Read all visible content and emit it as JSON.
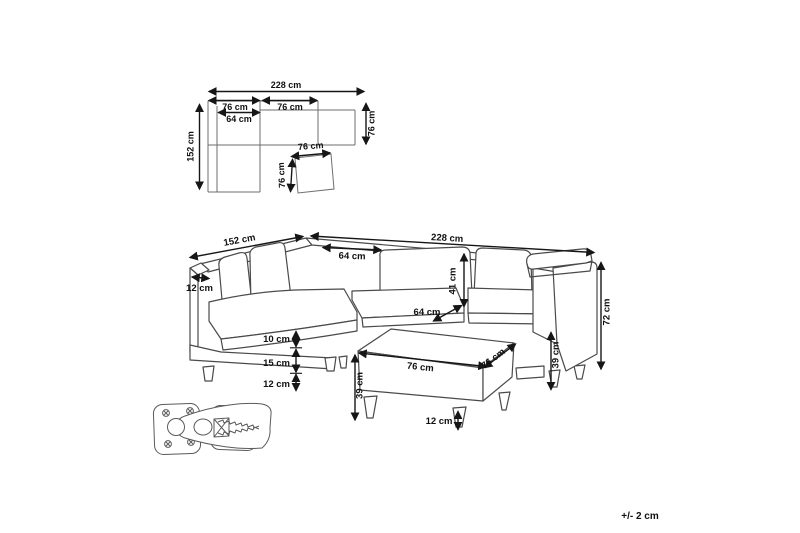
{
  "plan_view": {
    "total_width": "228 cm",
    "left_module_width": "76 cm",
    "right_module_width": "76 cm",
    "seat_width": "64 cm",
    "total_depth": "152 cm",
    "right_depth": "76 cm",
    "ottoman_width": "76 cm",
    "ottoman_depth": "76 cm"
  },
  "perspective_view": {
    "left_side_length": "152 cm",
    "total_width": "228 cm",
    "back_cushion_width": "64 cm",
    "armrest_thickness": "12 cm",
    "backrest_cushion_height": "41 cm",
    "seat_depth": "64 cm",
    "seat_cushion_height": "10 cm",
    "base_height": "15 cm",
    "leg_height": "12 cm",
    "ottoman_width": "76 cm",
    "ottoman_depth": "76 cm",
    "ottoman_height": "39 cm",
    "ottoman_leg_height": "12 cm",
    "seat_height": "39 cm",
    "total_height": "72 cm"
  },
  "footer": {
    "tolerance": "+/- 2 cm"
  },
  "colors": {
    "background": "#ffffff",
    "drawing_line": "#4a4a4a",
    "dimension_line": "#161616"
  }
}
